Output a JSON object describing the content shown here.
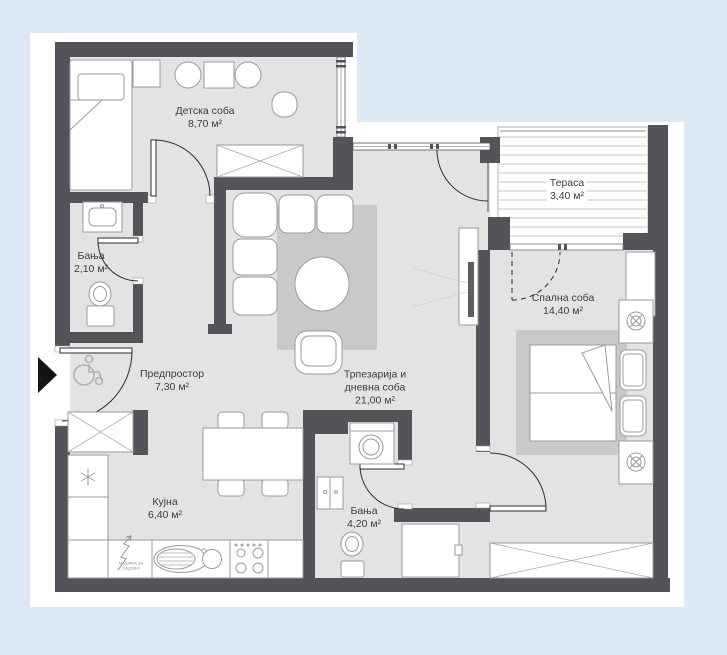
{
  "plan": {
    "background_color": "#dbeaf6",
    "sheet_color": "#ffffff",
    "wall_color": "#53545a",
    "floor_color": "#e3e3e3",
    "rug_color": "#c9c9c9",
    "rooms": [
      {
        "id": "detska-soba",
        "name": "Детска соба",
        "area": "8,70 м²"
      },
      {
        "id": "banja-mala",
        "name": "Бања",
        "area": "2,10 м²"
      },
      {
        "id": "predprostor",
        "name": "Предпростор",
        "area": "7,30 м²"
      },
      {
        "id": "kujna",
        "name": "Кујна",
        "area": "6,40 м²"
      },
      {
        "id": "trpezarija",
        "name_line1": "Трпезарија и",
        "name_line2": "дневна соба",
        "area": "21,00 м²"
      },
      {
        "id": "banja-golema",
        "name": "Бања",
        "area": "4,20 м²"
      },
      {
        "id": "spalna-soba",
        "name": "Спална соба",
        "area": "14,40 м²"
      },
      {
        "id": "terasa",
        "name": "Тераса",
        "area": "3,40 м²"
      }
    ],
    "annotations": {
      "dishwasher_line1": "машина за",
      "dishwasher_line2": "садови"
    }
  }
}
